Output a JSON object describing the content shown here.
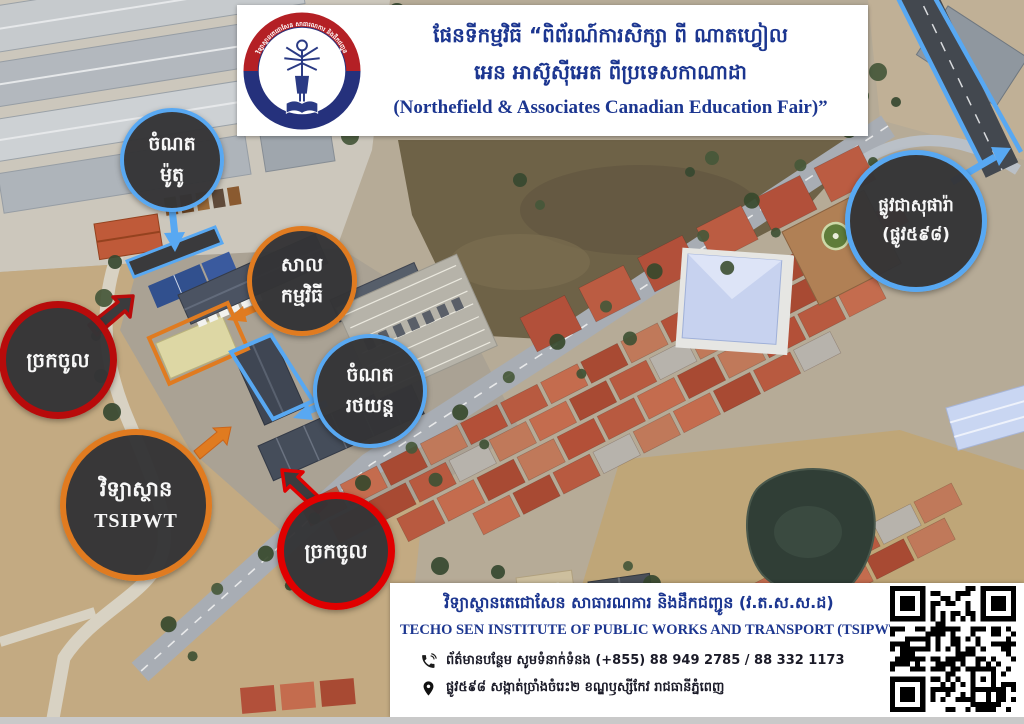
{
  "header": {
    "title_line1": "ផែនទីកម្មវិធី “ពិព័រណ៍ការសិក្សា ពី ណាតហ្វៀល",
    "title_line2": "អេន អាស៊ូស៊ីអេត ពីប្រទេសកាណាដា",
    "title_line3": "(Northefield & Associates Canadian Education Fair)”"
  },
  "logo": {
    "ring_top_text": "វិទ្យាស្ថានតេជោសែន សាធារណការ និងដឹកជញ្ជូន",
    "ring_bottom_text": "TECHO SEN INSTITUTE OF PUBLIC WORKS AND TRANSPORT"
  },
  "callouts": [
    {
      "id": "moto-parking",
      "line1": "ចំណត",
      "line2": "ម៉ូតូ",
      "color": "#58a8f2"
    },
    {
      "id": "event-hall",
      "line1": "សាល",
      "line2": "កម្មវិធី",
      "color": "#e07b20"
    },
    {
      "id": "car-parking",
      "line1": "ចំណត",
      "line2": "រថយន្ត",
      "color": "#58a8f2"
    },
    {
      "id": "entrance-west",
      "line1": "ច្រកចូល",
      "color": "#b80b0b"
    },
    {
      "id": "institute-tsipwt",
      "line1": "វិទ្យាស្ថាន",
      "line2": "TSIPWT",
      "color": "#e07b20"
    },
    {
      "id": "entrance-south",
      "line1": "ច្រកចូល",
      "color": "#e00000"
    },
    {
      "id": "street-598",
      "line1": "ផ្លូវជាសុផារ៉ា",
      "line2": "(ផ្លូវ៥៩៨)",
      "color": "#58a8f2"
    }
  ],
  "footer": {
    "institute_khmer": "វិទ្យាស្ថានតេជោសែន សាធារណការ និងដឹកជញ្ជូន  (វ.ត.ស.ស.ដ)",
    "institute_english": "TECHO SEN INSTITUTE OF PUBLIC WORKS AND TRANSPORT (TSIPWT)",
    "phone_line": "ព័ត៌មានបន្ថែម សូមទំនាក់ទំនង (+855) 88 949 2785 / 88 332 1173",
    "address_line": "ផ្លូវ៥៩៨ សង្កាត់ច្រាំងចំរេះ២ ខណ្ឌឫស្សីកែវ រាជធានីភ្នំពេញ"
  },
  "colors": {
    "accent_blue": "#58a8f2",
    "accent_orange": "#e07b20",
    "accent_red": "#e00000",
    "accent_dark_red": "#b80b0b",
    "navy_text": "#1c3690"
  }
}
